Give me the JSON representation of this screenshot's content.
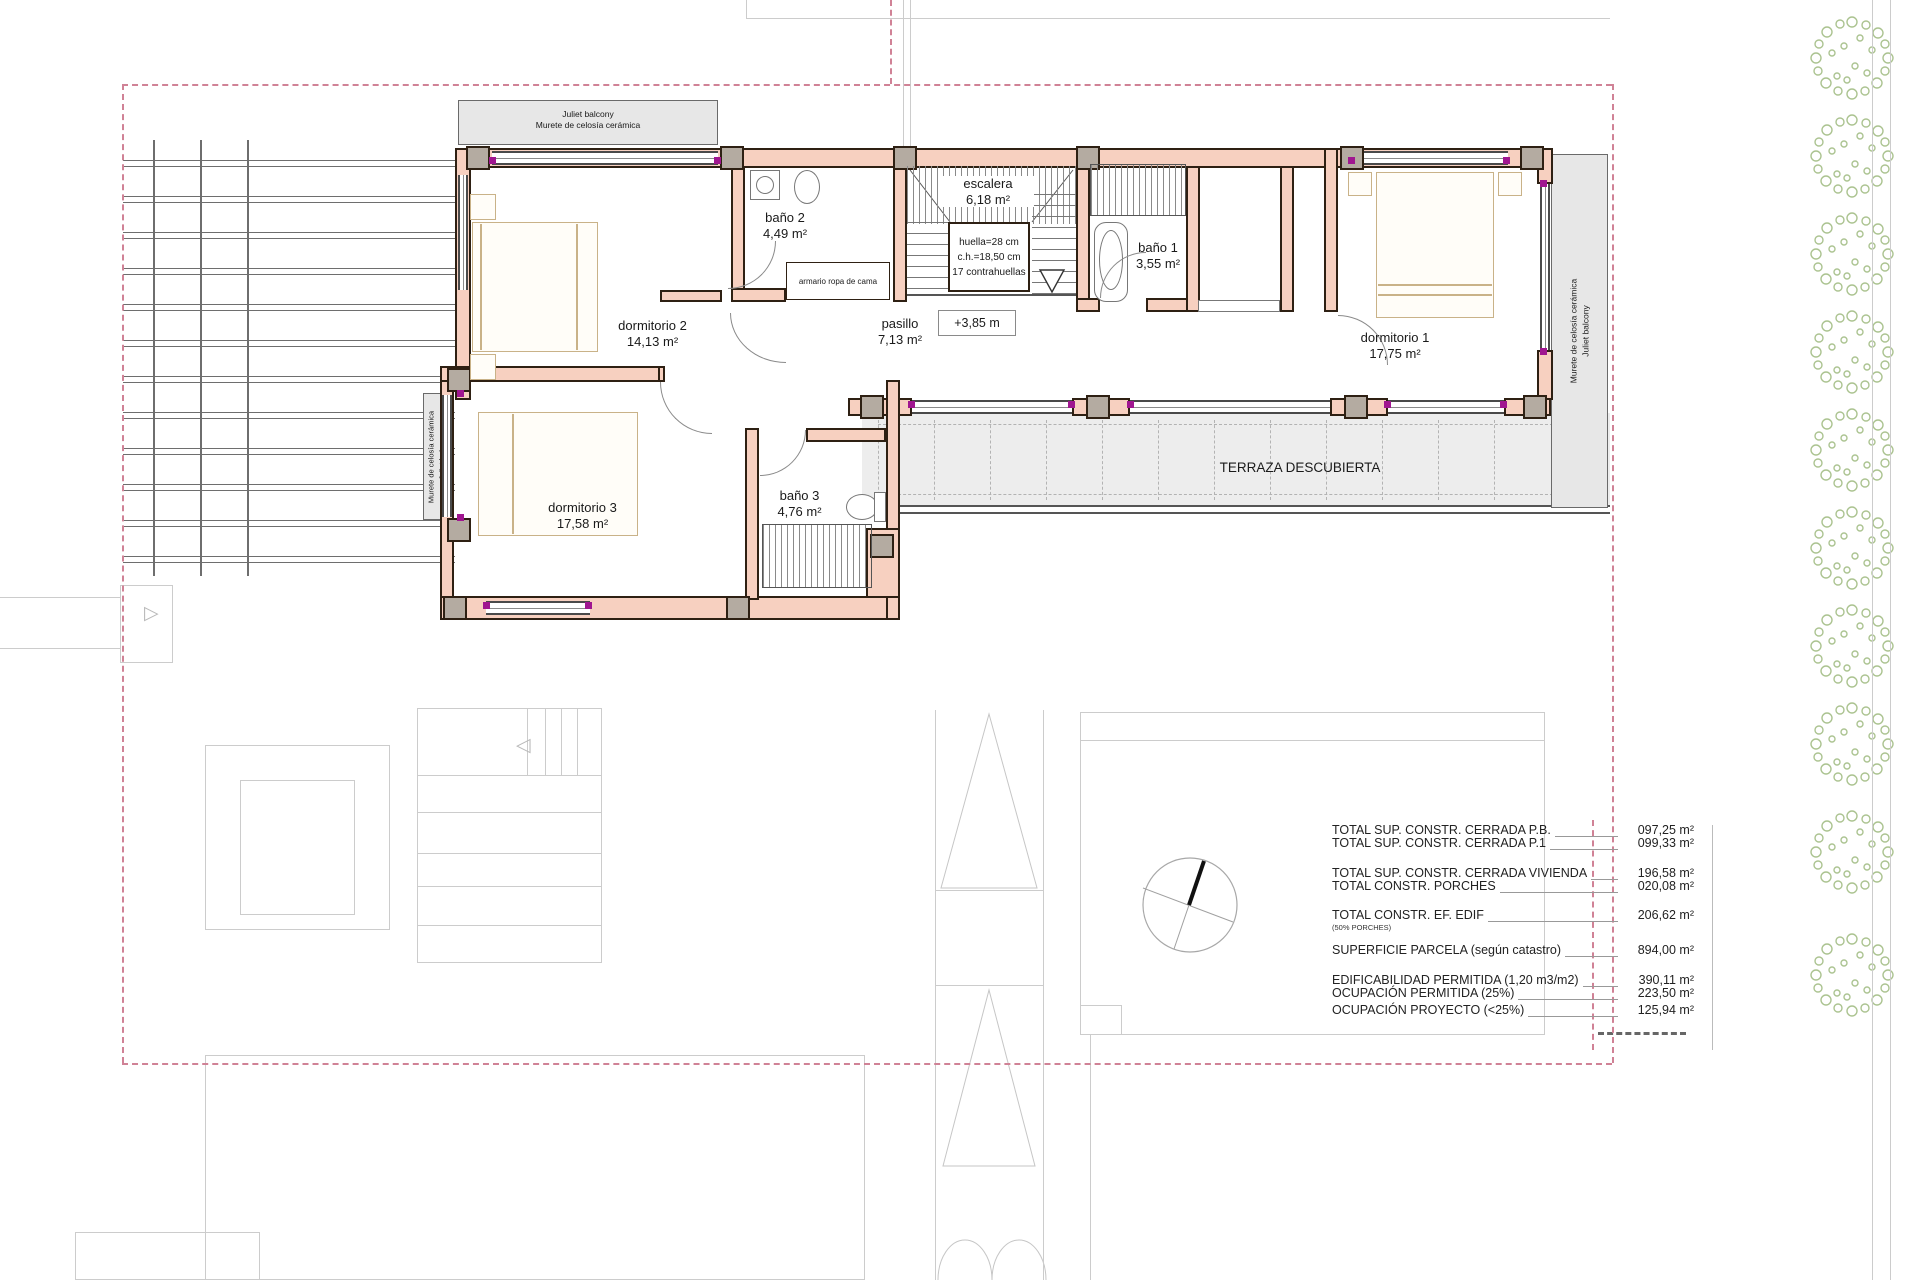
{
  "plan": {
    "balcony_top": {
      "line1": "Juliet balcony",
      "line2": "Murete de celosía cerámica"
    },
    "balcony_left": {
      "line1": "Murete de celosía cerámica",
      "line2": "Juliet balcony"
    },
    "balcony_right": {
      "line1": "Murete de celosía cerámica",
      "line2": "Juliet balcony"
    },
    "rooms": {
      "dormitorio2": {
        "name": "dormitorio 2",
        "area": "14,13 m²"
      },
      "bano2": {
        "name": "baño 2",
        "area": "4,49 m²"
      },
      "escalera": {
        "name": "escalera",
        "area": "6,18 m²"
      },
      "bano1": {
        "name": "baño 1",
        "area": "3,55 m²"
      },
      "dormitorio1": {
        "name": "dormitorio 1",
        "area": "17,75 m²"
      },
      "pasillo": {
        "name": "pasillo",
        "area": "7,13 m²"
      },
      "dormitorio3": {
        "name": "dormitorio 3",
        "area": "17,58 m²"
      },
      "bano3": {
        "name": "baño 3",
        "area": "4,76 m²"
      },
      "level": "+3,85 m",
      "armario": "armario ropa de cama",
      "terraza": "TERRAZA DESCUBIERTA"
    },
    "stairs": {
      "line1": "huella=28 cm",
      "line2": "c.h.=18,50 cm",
      "line3": "17 contrahuellas"
    }
  },
  "areas_table": {
    "rows": [
      {
        "label": "TOTAL SUP. CONSTR. CERRADA P.B.",
        "value": "097,25 m²"
      },
      {
        "label": "TOTAL SUP. CONSTR. CERRADA P.1",
        "value": "099,33 m²"
      },
      {
        "label": "TOTAL SUP. CONSTR. CERRADA VIVIENDA",
        "value": "196,58 m²"
      },
      {
        "label": "TOTAL  CONSTR. PORCHES",
        "value": "020,08 m²"
      },
      {
        "label": "TOTAL  CONSTR.  EF. EDIF",
        "value": "206,62 m²",
        "note": "(50% PORCHES)"
      },
      {
        "label": "SUPERFICIE PARCELA (según catastro)",
        "value": "894,00 m²"
      },
      {
        "label": "EDIFICABILIDAD PERMITIDA (1,20 m3/m2)",
        "value": "390,11 m²"
      },
      {
        "label": "OCUPACIÓN PERMITIDA (25%)",
        "value": "223,50 m²"
      },
      {
        "label": "OCUPACIÓN PROYECTO (<25%)",
        "value": "125,94 m²"
      }
    ]
  },
  "colors": {
    "wall_fill": "#f7d0c0",
    "wall_outline": "#2e2013",
    "column_fill": "#b4aba1",
    "boundary_pink": "#d08296",
    "corner_magenta": "#a01690",
    "terrace_gray": "#ededed",
    "balcony_gray": "#e7e7e7",
    "tree_green": "#a3bd85"
  }
}
